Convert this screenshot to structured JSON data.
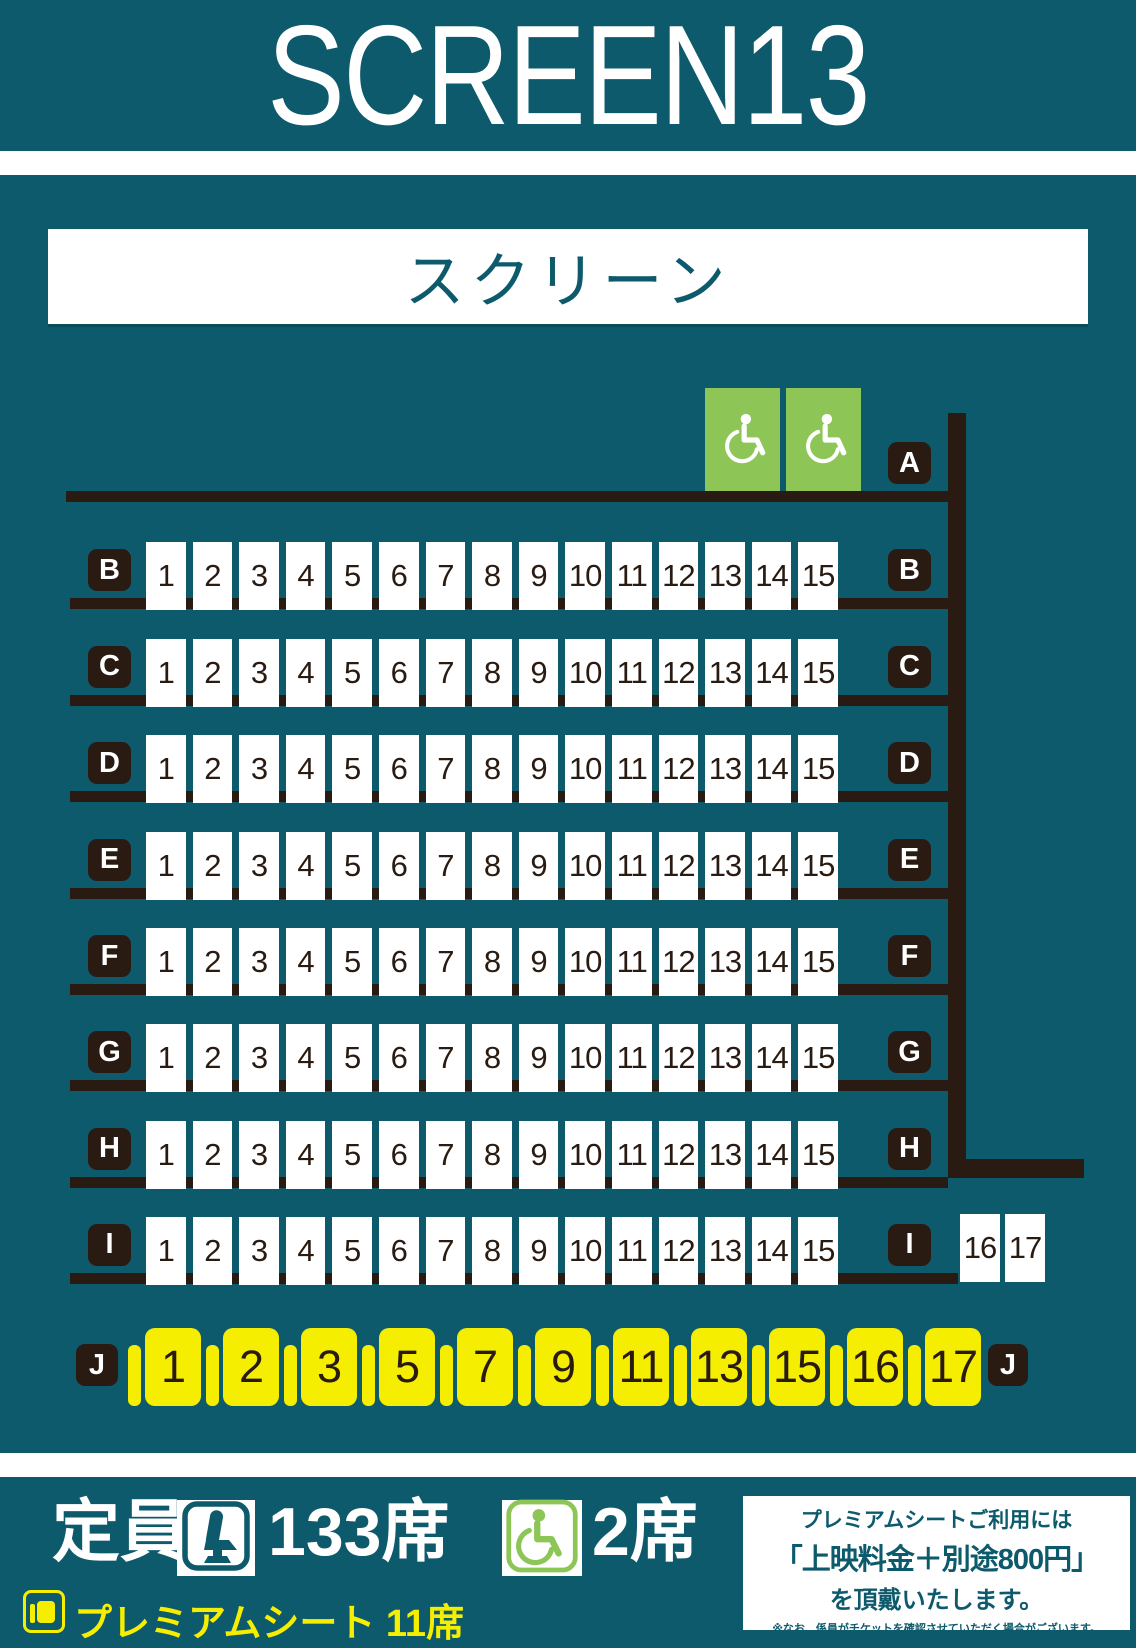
{
  "header": {
    "title": "SCREEN13"
  },
  "screen": {
    "label": "スクリーン"
  },
  "colors": {
    "background_teal": "#0D5A6C",
    "seat_outline_dark": "#2A1B12",
    "accessible_green": "#8DC556",
    "premium_yellow": "#F6EE00",
    "seat_white": "#FFFFFF"
  },
  "seat_map": {
    "rows": [
      {
        "id": "A",
        "right_label": "A",
        "accessible_seat_count": 2,
        "seats": []
      },
      {
        "id": "B",
        "left_label": "B",
        "right_label": "B",
        "seats": [
          "1",
          "2",
          "3",
          "4",
          "5",
          "6",
          "7",
          "8",
          "9",
          "10",
          "11",
          "12",
          "13",
          "14",
          "15"
        ]
      },
      {
        "id": "C",
        "left_label": "C",
        "right_label": "C",
        "seats": [
          "1",
          "2",
          "3",
          "4",
          "5",
          "6",
          "7",
          "8",
          "9",
          "10",
          "11",
          "12",
          "13",
          "14",
          "15"
        ]
      },
      {
        "id": "D",
        "left_label": "D",
        "right_label": "D",
        "seats": [
          "1",
          "2",
          "3",
          "4",
          "5",
          "6",
          "7",
          "8",
          "9",
          "10",
          "11",
          "12",
          "13",
          "14",
          "15"
        ]
      },
      {
        "id": "E",
        "left_label": "E",
        "right_label": "E",
        "seats": [
          "1",
          "2",
          "3",
          "4",
          "5",
          "6",
          "7",
          "8",
          "9",
          "10",
          "11",
          "12",
          "13",
          "14",
          "15"
        ]
      },
      {
        "id": "F",
        "left_label": "F",
        "right_label": "F",
        "seats": [
          "1",
          "2",
          "3",
          "4",
          "5",
          "6",
          "7",
          "8",
          "9",
          "10",
          "11",
          "12",
          "13",
          "14",
          "15"
        ]
      },
      {
        "id": "G",
        "left_label": "G",
        "right_label": "G",
        "seats": [
          "1",
          "2",
          "3",
          "4",
          "5",
          "6",
          "7",
          "8",
          "9",
          "10",
          "11",
          "12",
          "13",
          "14",
          "15"
        ]
      },
      {
        "id": "H",
        "left_label": "H",
        "right_label": "H",
        "seats": [
          "1",
          "2",
          "3",
          "4",
          "5",
          "6",
          "7",
          "8",
          "9",
          "10",
          "11",
          "12",
          "13",
          "14",
          "15"
        ]
      },
      {
        "id": "I",
        "left_label": "I",
        "right_label": "I",
        "seats": [
          "1",
          "2",
          "3",
          "4",
          "5",
          "6",
          "7",
          "8",
          "9",
          "10",
          "11",
          "12",
          "13",
          "14",
          "15"
        ],
        "extra_seats": [
          "16",
          "17"
        ]
      },
      {
        "id": "J",
        "left_label": "J",
        "right_label": "J",
        "premium": true,
        "seats": [
          "1",
          "2",
          "3",
          "5",
          "7",
          "9",
          "11",
          "13",
          "15",
          "16",
          "17"
        ]
      }
    ]
  },
  "footer": {
    "capacity_label": "定員",
    "seat_count": "133席",
    "wheelchair_count": "2席",
    "premium_label": "プレミアムシート 11席",
    "notice": {
      "line1": "プレミアムシートご利用には",
      "line2": "「上映料金＋別途800円」",
      "line3": "を頂戴いたします。",
      "note1": "※なお、係員がチケットを確認させていただく場合がございます。",
      "note2": "ご了承くださいますようお願いいたします。"
    }
  }
}
